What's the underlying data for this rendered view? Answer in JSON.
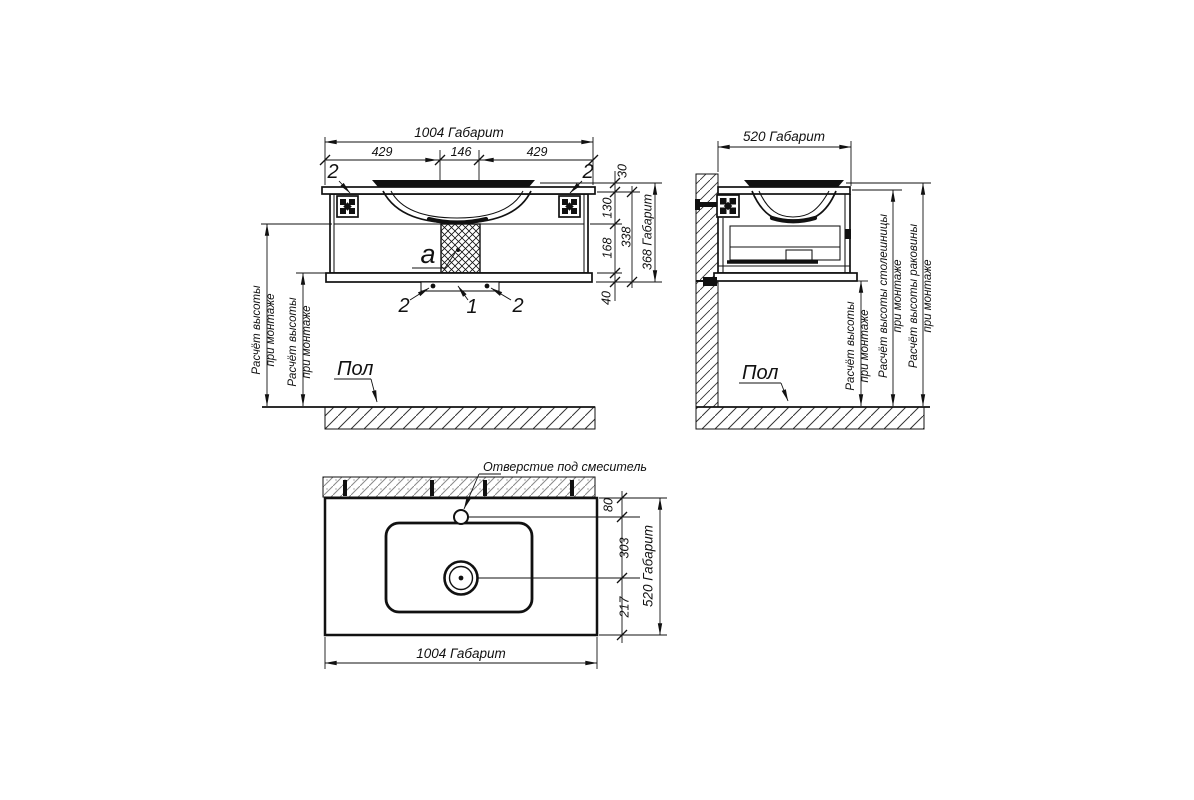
{
  "drawing": {
    "background": "#ffffff",
    "line_color": "#111111",
    "front_view": {
      "dim_width_total": "1004 Габарит",
      "dim_width_left": "429",
      "dim_width_center": "146",
      "dim_width_right": "429",
      "dim_rim_offset": "30",
      "dim_top_section": "130",
      "dim_bottom_section": "168",
      "dim_plinth": "40",
      "dim_body_height": "338",
      "dim_height_total": "368 Габарит",
      "section_label": "a",
      "callout_1": "1",
      "callout_2": "2",
      "height_note_line1": "Расчёт высоты",
      "height_note_line2": "при монтаже",
      "floor_label": "Пол"
    },
    "side_view": {
      "dim_depth_total": "520 Габарит",
      "height_note_line1": "Расчёт высоты",
      "height_note_line2": "при монтаже",
      "countertop_note_line1": "Расчёт высоты столешницы",
      "countertop_note_line2": "при монтаже",
      "basin_note_line1": "Расчёт высоты раковины",
      "basin_note_line2": "при монтаже",
      "floor_label": "Пол"
    },
    "top_view": {
      "faucet_hole_label": "Отверстие под смеситель",
      "dim_width_total": "1004 Габарит",
      "dim_depth_total": "520 Габарит",
      "dim_faucet_offset": "80",
      "dim_drain_offset": "303",
      "dim_drain_to_edge": "217"
    }
  }
}
